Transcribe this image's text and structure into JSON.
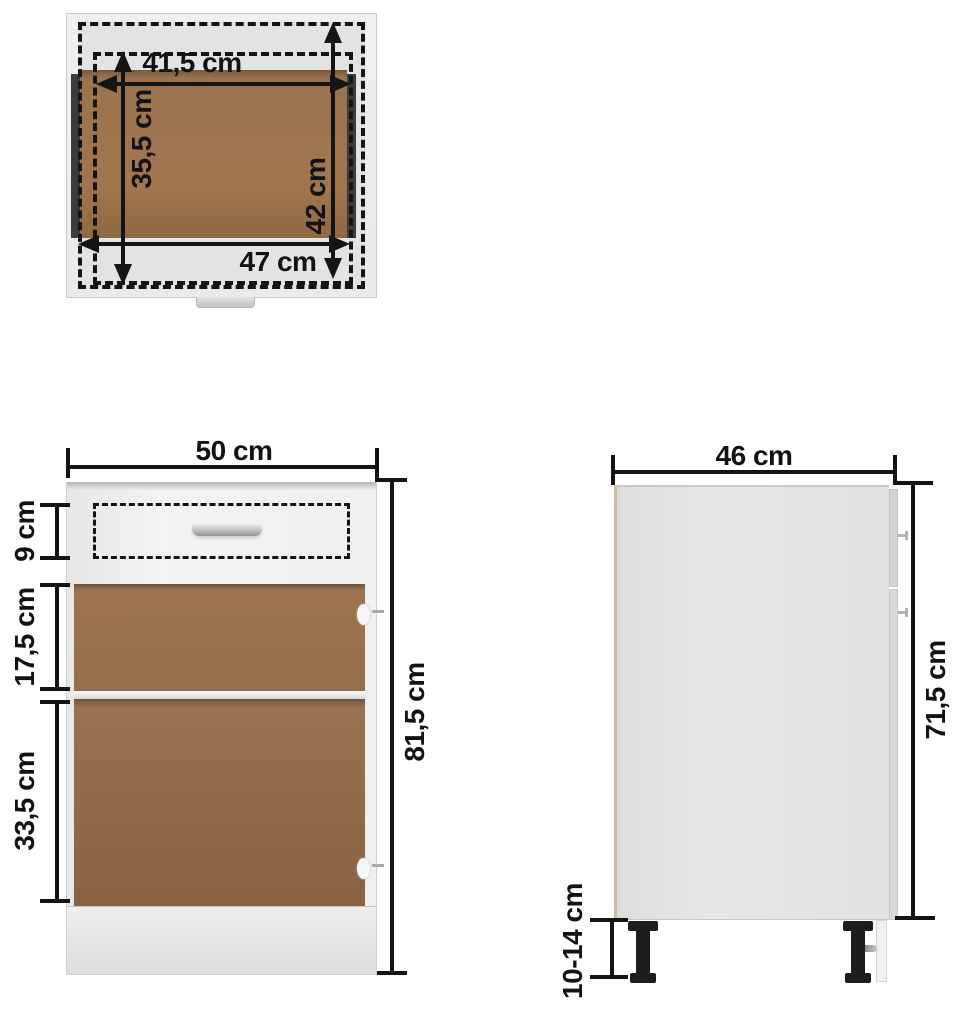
{
  "figure": {
    "title": "cabinet-dimension-diagram",
    "unit": "cm",
    "top_view": {
      "inner_width": "41,5 cm",
      "inner_depth": "35,5 cm",
      "outer_depth": "42 cm",
      "outer_width": "47 cm"
    },
    "front_view": {
      "width": "50 cm",
      "drawer_height": "9 cm",
      "upper_opening_height": "17,5 cm",
      "lower_opening_height": "33,5 cm",
      "total_height": "81,5 cm"
    },
    "side_view": {
      "depth": "46 cm",
      "body_height": "71,5 cm",
      "leg_height": "10-14 cm"
    },
    "colors": {
      "wood_brown": "#9d7350",
      "panel_grey": "#e2e1e1",
      "dimension_black": "#141414",
      "leg_black": "#1d1d1d"
    }
  }
}
